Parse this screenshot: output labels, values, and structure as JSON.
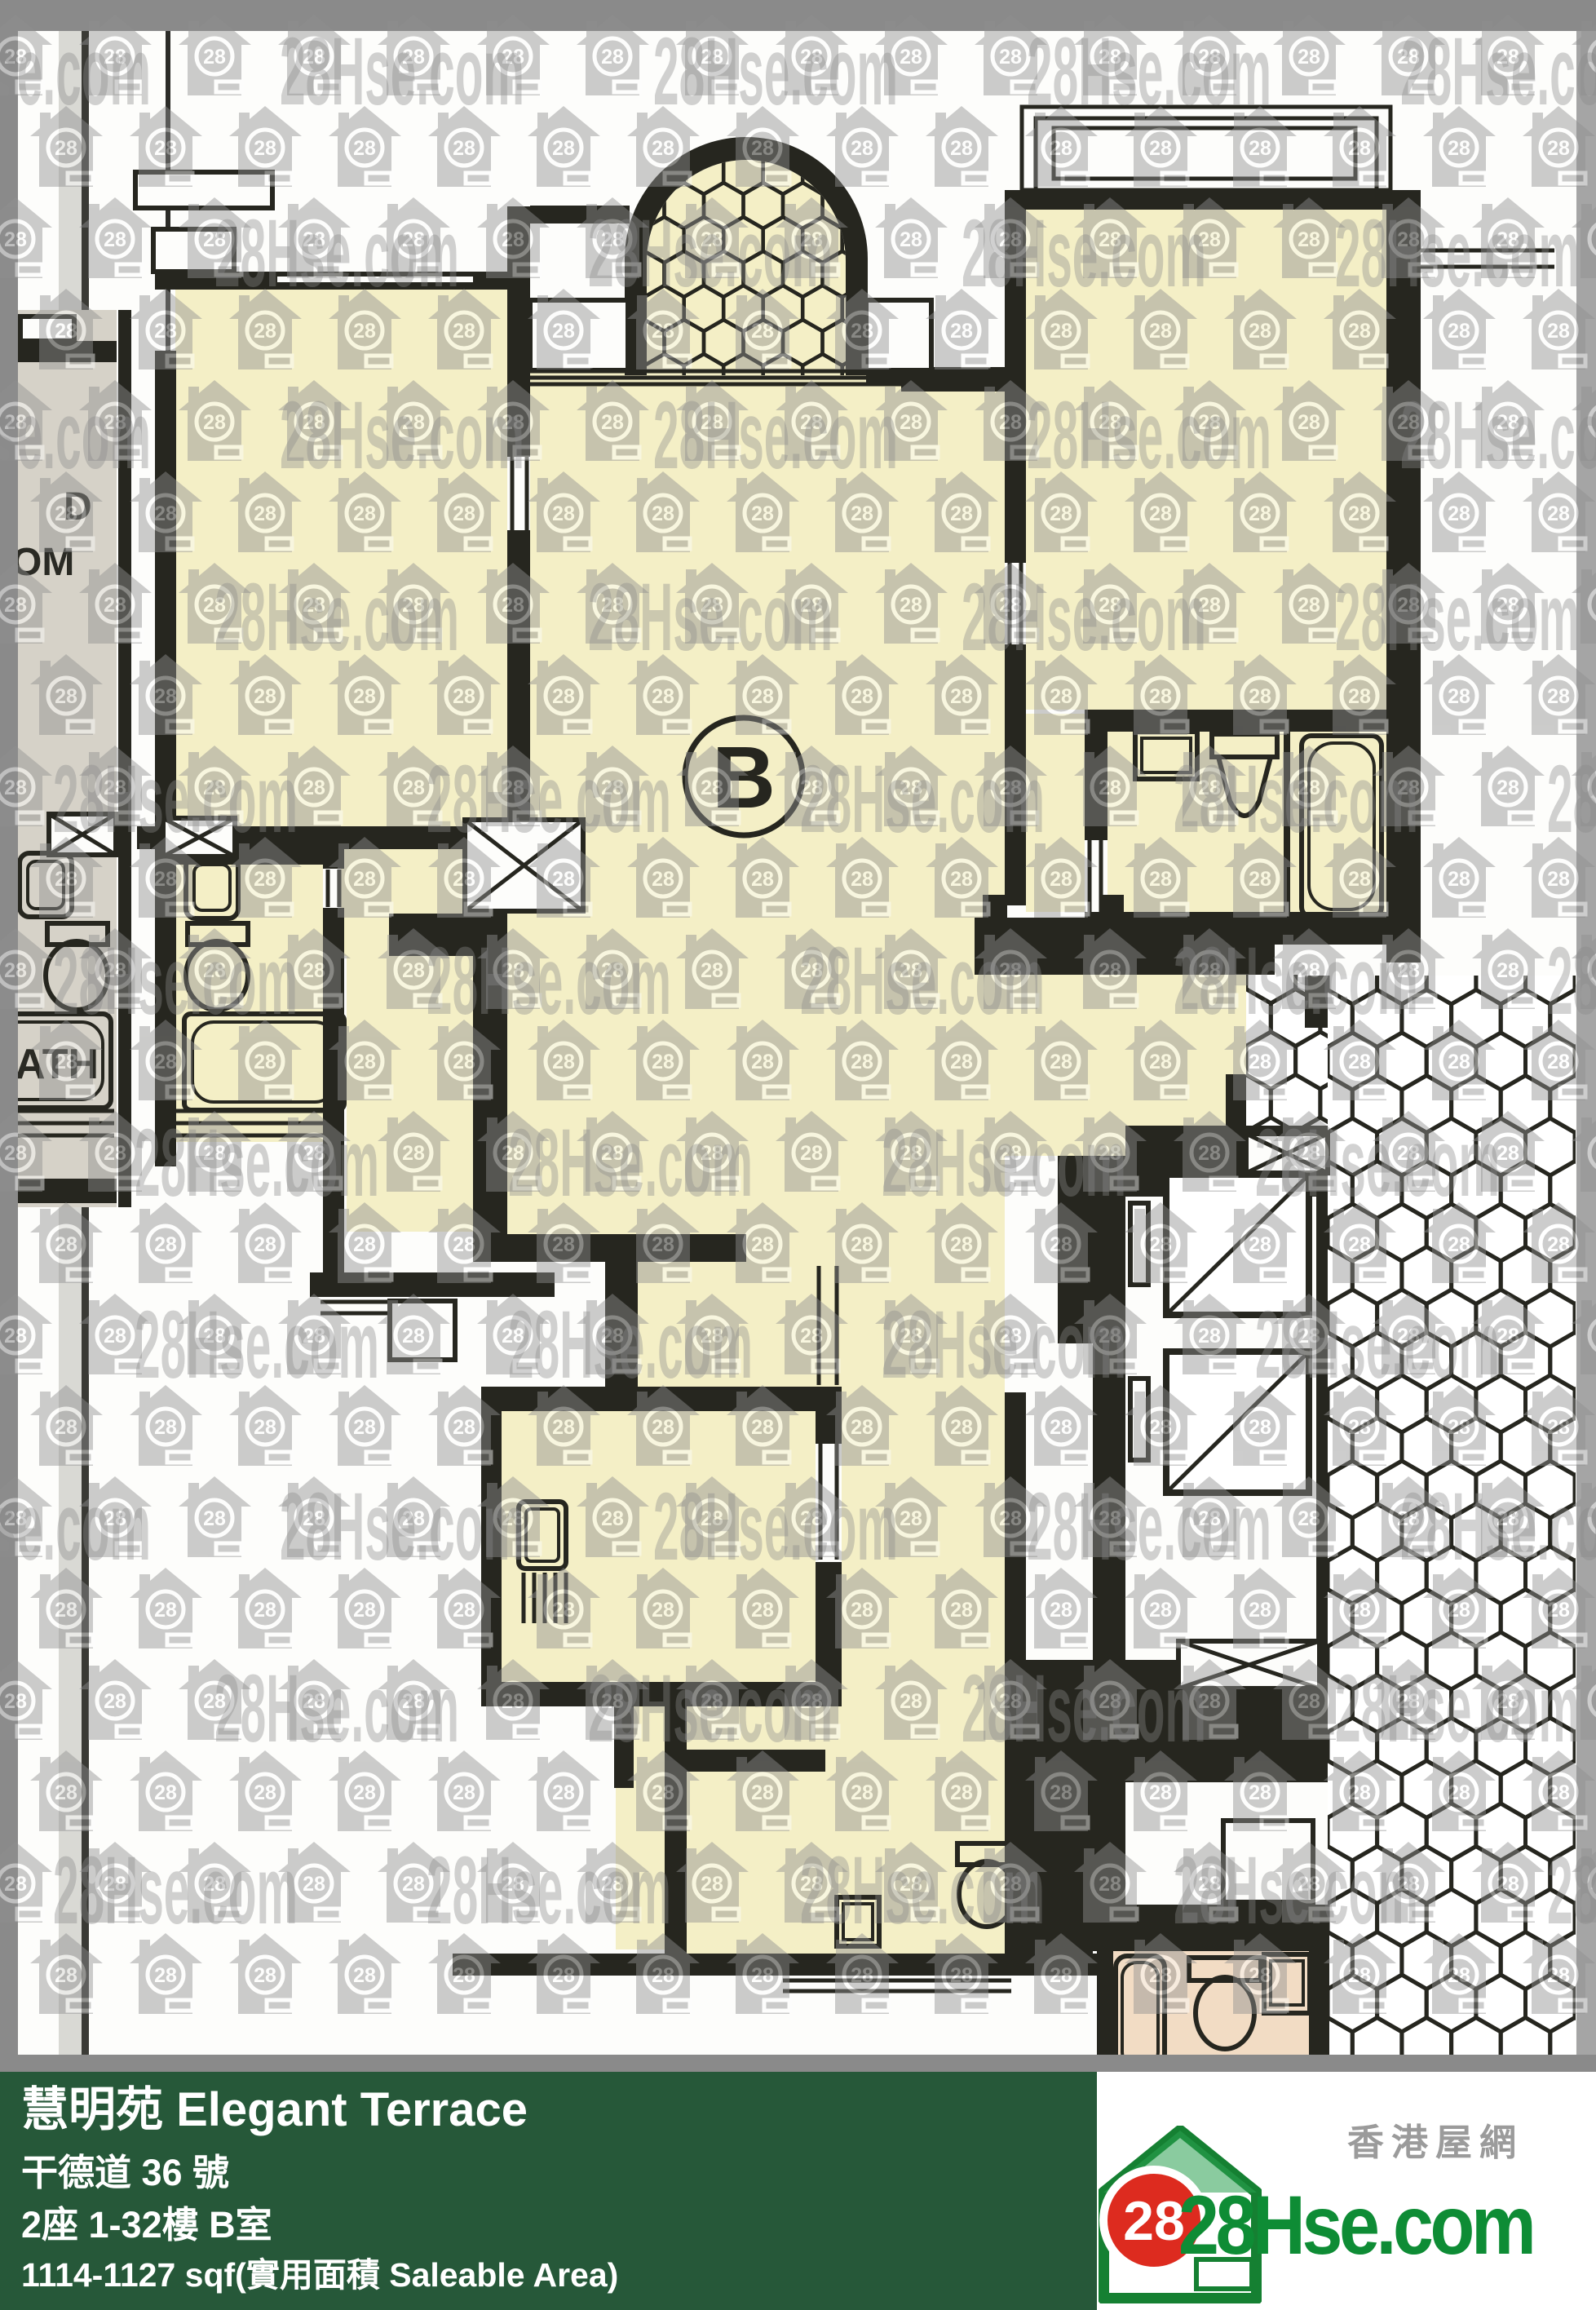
{
  "plan": {
    "unit_label": "B",
    "adjacent_unit_labels": {
      "bedroom_line1": "D",
      "bedroom_line2": "OM",
      "bath": "ATH"
    }
  },
  "watermark": {
    "brand_text": "28Hse.com",
    "badge": "28"
  },
  "info_bar": {
    "estate_name": "慧明苑 Elegant Terrace",
    "address": "干德道 36 號",
    "block_floor_unit": "2座 1-32樓 B室",
    "area": "1114-1127 sqf(實用面積 Saleable Area)",
    "background": "#265839",
    "text_color": "#ffffff"
  },
  "logo": {
    "chinese_name": "香港屋網",
    "brand": "28Hse.com",
    "badge": "28",
    "brand_color": "#0e8c35",
    "badge_color": "#dd2b1f"
  },
  "colors": {
    "paper": "#fdfdfb",
    "room_fill": "#f4efc6",
    "adjacent_room_fill": "#d6d2c8",
    "pink_bathroom_fill": "#f2dcc4",
    "wall": "#26261f",
    "scan_margin": "#8a8a8a"
  }
}
